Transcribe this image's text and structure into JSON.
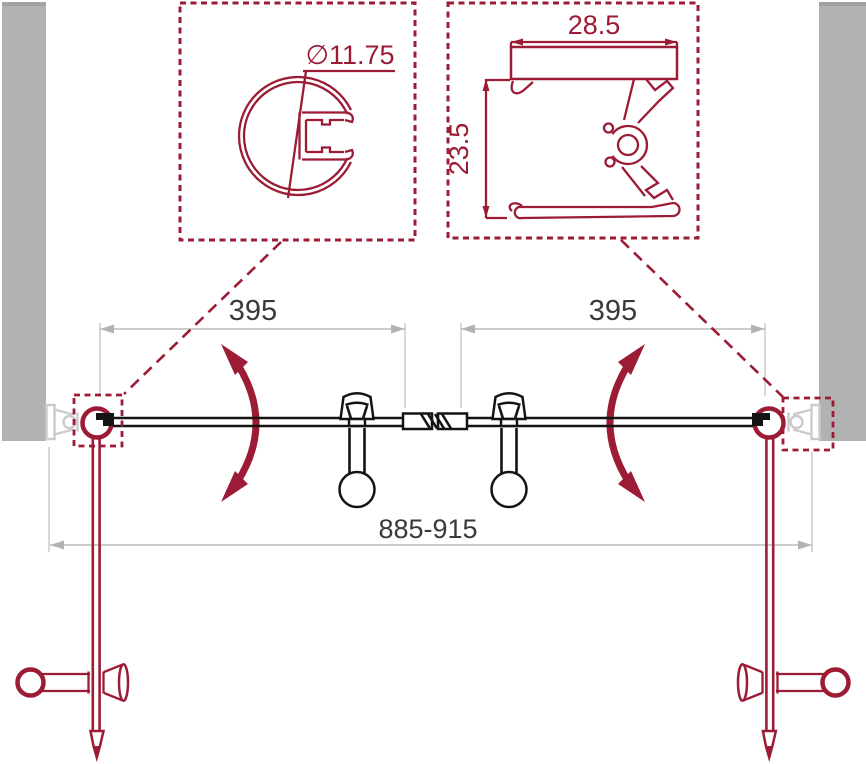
{
  "labels": {
    "hinge_diameter": "∅11.75",
    "profile_width": "28.5",
    "profile_height": "23.5",
    "left_door_width": "395",
    "right_door_width": "395",
    "overall_width": "885-915"
  },
  "colors": {
    "accent_red": "#9C1B35",
    "wall_gray": "#B2B2B2",
    "dim_gray": "#ACACAC",
    "text_dark": "#3A3A3A",
    "drawing_black": "#141414",
    "light_gray": "#CBCBCB"
  }
}
